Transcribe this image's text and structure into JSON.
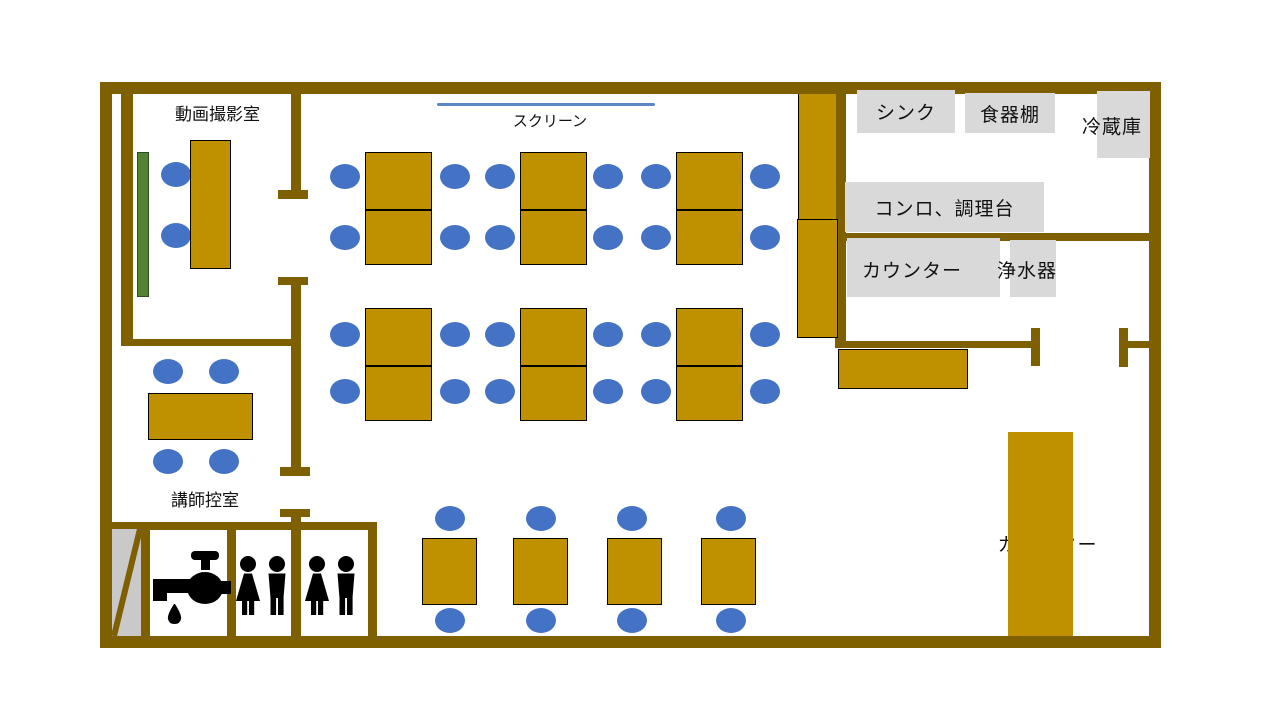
{
  "title": "教室レイアウト図",
  "colors": {
    "wall": "#7F6000",
    "furniture": "#BF9000",
    "chair": "#4472C4",
    "board": "#548235",
    "label_box": "#D9D9D9",
    "stair": "#C9C9C9",
    "screen_line": "#5B87C5",
    "icon": "#000000"
  },
  "rooms": {
    "video_room_label": "動画撮影室",
    "instructor_room_label": "講師控室"
  },
  "equipment_labels": {
    "screen": "スクリーン",
    "sink": "シンク",
    "cupboard": "食器棚",
    "refrigerator": "冷蔵庫",
    "stove_prep_counter": "コンロ、調理台",
    "kitchen_counter": "カウンター",
    "water_purifier": "浄水器",
    "lounge_counter": "カウンター"
  },
  "icons": {
    "washstand": "faucet-icon",
    "toilet_room_1": [
      "female-icon",
      "male-icon"
    ],
    "toilet_room_2": [
      "female-icon",
      "male-icon"
    ]
  },
  "furniture": {
    "chair_size": [
      30,
      25
    ],
    "chairs": [
      [
        176,
        174
      ],
      [
        176,
        235
      ],
      [
        345,
        176
      ],
      [
        455,
        176
      ],
      [
        500,
        176
      ],
      [
        608,
        176
      ],
      [
        656,
        176
      ],
      [
        765,
        176
      ],
      [
        345,
        237
      ],
      [
        455,
        237
      ],
      [
        500,
        237
      ],
      [
        608,
        237
      ],
      [
        656,
        237
      ],
      [
        765,
        237
      ],
      [
        345,
        334
      ],
      [
        455,
        334
      ],
      [
        500,
        334
      ],
      [
        608,
        334
      ],
      [
        656,
        334
      ],
      [
        765,
        334
      ],
      [
        345,
        391
      ],
      [
        455,
        391
      ],
      [
        500,
        391
      ],
      [
        608,
        391
      ],
      [
        656,
        391
      ],
      [
        765,
        391
      ],
      [
        168,
        371
      ],
      [
        224,
        371
      ],
      [
        168,
        461
      ],
      [
        224,
        461
      ],
      [
        450,
        518
      ],
      [
        541,
        518
      ],
      [
        632,
        518
      ],
      [
        731,
        518
      ],
      [
        450,
        620
      ],
      [
        541,
        620
      ],
      [
        632,
        620
      ],
      [
        731,
        620
      ]
    ],
    "table_groups": {
      "w": 67,
      "h": 113,
      "positions": [
        [
          365,
          152
        ],
        [
          520,
          152
        ],
        [
          676,
          152
        ],
        [
          365,
          308
        ],
        [
          520,
          308
        ],
        [
          676,
          308
        ]
      ]
    },
    "single_tables": {
      "w": 55,
      "h": 67,
      "positions": [
        [
          422,
          538
        ],
        [
          513,
          538
        ],
        [
          607,
          538
        ],
        [
          701,
          538
        ]
      ]
    },
    "video_table": [
      190,
      140,
      41,
      129
    ],
    "instructor_table": [
      148,
      393,
      105,
      47
    ],
    "pillar_upper": [
      798,
      94,
      37,
      125
    ],
    "pillar_lower": [
      797,
      219,
      41,
      119
    ],
    "kitchen_side_counter": [
      838,
      349,
      130,
      40
    ],
    "lounge_counter_rect": [
      1008,
      432,
      65,
      204
    ],
    "green_board": [
      137,
      152,
      12,
      145
    ],
    "screen_line": [
      437,
      103,
      218,
      3
    ]
  }
}
